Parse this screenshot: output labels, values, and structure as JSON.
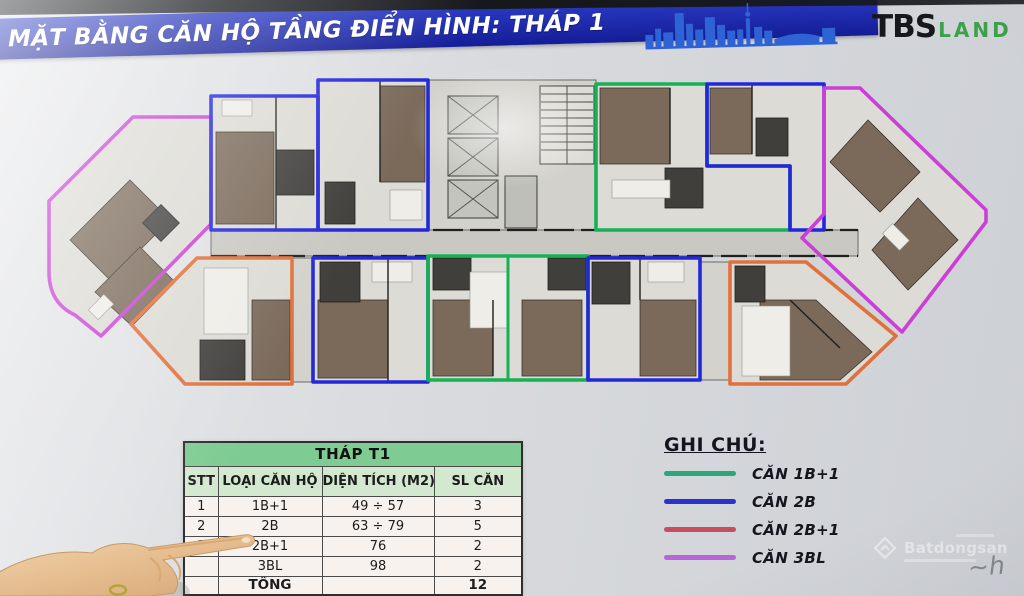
{
  "header": {
    "title": "MẶT BẰNG CĂN HỘ TẦNG ĐIỂN HÌNH: THÁP 1",
    "banner_color": "#1c2aae",
    "skyline_color": "#2e63d6",
    "logo": {
      "primary": "TBS",
      "secondary": "LAND",
      "secondary_color": "#3da04a"
    }
  },
  "floor_plan": {
    "unit_colors": {
      "1B+1": "#17b054",
      "2B": "#2227da",
      "2B+1": "#e1713b",
      "3BL": "#cb3fd6"
    },
    "units": [
      {
        "position": "left-wing",
        "type": "3BL"
      },
      {
        "position": "lower-left-diagonal",
        "type": "2B+1"
      },
      {
        "position": "top-1",
        "type": "2B"
      },
      {
        "position": "top-2",
        "type": "2B"
      },
      {
        "position": "top-right-of-core",
        "type": "1B+1"
      },
      {
        "position": "top-3",
        "type": "2B"
      },
      {
        "position": "right-wing",
        "type": "3BL"
      },
      {
        "position": "bottom-1",
        "type": "2B"
      },
      {
        "position": "bottom-center-left",
        "type": "1B+1"
      },
      {
        "position": "bottom-center-right",
        "type": "1B+1"
      },
      {
        "position": "bottom-2",
        "type": "2B"
      },
      {
        "position": "lower-right-diagonal",
        "type": "2B+1"
      }
    ]
  },
  "table": {
    "title": "THÁP T1",
    "headers": [
      "STT",
      "LOẠI CĂN HỘ",
      "DIỆN TÍCH (M2)",
      "SL CĂN"
    ],
    "rows": [
      {
        "stt": "1",
        "type": "1B+1",
        "area": "49 ÷ 57",
        "count": "3"
      },
      {
        "stt": "2",
        "type": "2B",
        "area": "63 ÷ 79",
        "count": "5"
      },
      {
        "stt": "3",
        "type": "2B+1",
        "area": "76",
        "count": "2"
      },
      {
        "stt": "",
        "type": "3BL",
        "area": "98",
        "count": "2"
      }
    ],
    "total_label": "TỔNG",
    "total_count": "12"
  },
  "legend": {
    "title": "GHI CHÚ:",
    "items": [
      {
        "label": "CĂN 1B+1",
        "color": "#27a97b"
      },
      {
        "label": "CĂN 2B",
        "color": "#2a33cb"
      },
      {
        "label": "CĂN 2B+1",
        "color": "#c64e60"
      },
      {
        "label": "CĂN 3BL",
        "color": "#b765d8"
      }
    ]
  },
  "watermark": {
    "brand": "Batdongsan",
    "mark": "~h"
  }
}
